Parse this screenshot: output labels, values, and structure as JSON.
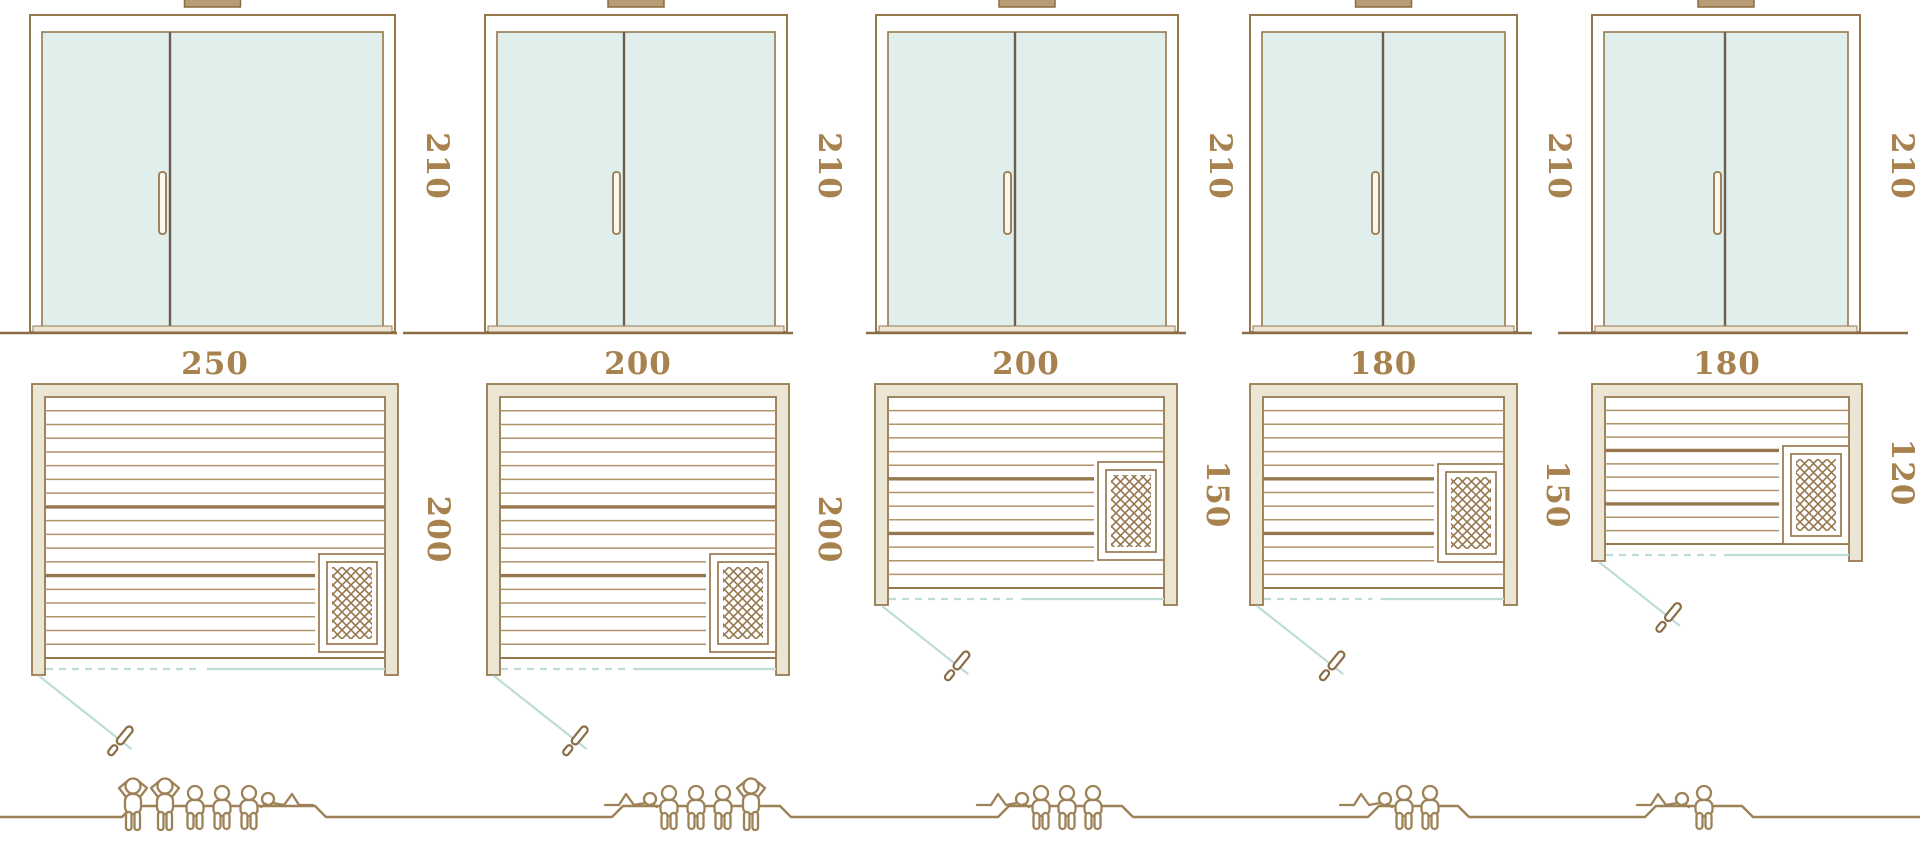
{
  "diagram_title": "sauna-size-comparison",
  "door_height_label": "210",
  "colors": {
    "line": "#96784f",
    "line_dark": "#8b6d45",
    "plank": "#b1936a",
    "plank_thick": "#97774e",
    "wall_fill": "#eae6d3",
    "glass": "#e1efec",
    "teal": "#bedcd8",
    "label": "#a8824e",
    "figure": "#9d8157",
    "divider": "#6b5e50",
    "vent_fill": "#b79c74",
    "white": "#ffffff"
  },
  "ground_y": 817,
  "platform_y": 806,
  "saunas": [
    {
      "name": "sauna-250x200",
      "width_label": "250",
      "depth_label": "200",
      "height_label": "210",
      "capacity": {
        "standing": 2,
        "sitting": 3,
        "lying": 1
      },
      "geometry": {
        "door": {
          "x": 30,
          "w": 365,
          "divider_x": 170
        },
        "plan": {
          "x": 32,
          "y": 384,
          "w": 366,
          "h": 291
        },
        "heater_y": 554,
        "swing_len": 118,
        "ground": [
          0,
          397
        ],
        "platform": [
          122,
          315
        ],
        "figures": [
          {
            "type": "standing",
            "x": 133
          },
          {
            "type": "standing",
            "x": 165
          },
          {
            "type": "sitting",
            "x": 195
          },
          {
            "type": "sitting",
            "x": 222
          },
          {
            "type": "sitting",
            "x": 249
          },
          {
            "type": "lying",
            "x": 268,
            "flip": false
          }
        ]
      }
    },
    {
      "name": "sauna-200x200",
      "width_label": "200",
      "depth_label": "200",
      "height_label": "210",
      "capacity": {
        "standing": 1,
        "sitting": 3,
        "lying": 1
      },
      "geometry": {
        "door": {
          "x": 485,
          "w": 302,
          "divider_x": 624
        },
        "plan": {
          "x": 487,
          "y": 384,
          "w": 302,
          "h": 291
        },
        "heater_y": 554,
        "swing_len": 118,
        "ground": [
          403,
          793
        ],
        "platform": [
          612,
          780
        ],
        "figures": [
          {
            "type": "lying",
            "x": 650,
            "flip": true
          },
          {
            "type": "sitting",
            "x": 669
          },
          {
            "type": "sitting",
            "x": 696
          },
          {
            "type": "sitting",
            "x": 723
          },
          {
            "type": "standing",
            "x": 751
          }
        ]
      }
    },
    {
      "name": "sauna-200x150",
      "width_label": "200",
      "depth_label": "150",
      "height_label": "210",
      "capacity": {
        "standing": 0,
        "sitting": 3,
        "lying": 1
      },
      "geometry": {
        "door": {
          "x": 876,
          "w": 302,
          "divider_x": 1015
        },
        "plan": {
          "x": 875,
          "y": 384,
          "w": 302,
          "h": 221
        },
        "heater_y": 462,
        "swing_len": 110,
        "ground": [
          866,
          1186
        ],
        "platform": [
          998,
          1122
        ],
        "figures": [
          {
            "type": "lying",
            "x": 1022,
            "flip": true
          },
          {
            "type": "sitting",
            "x": 1041
          },
          {
            "type": "sitting",
            "x": 1067
          },
          {
            "type": "sitting",
            "x": 1093
          }
        ]
      }
    },
    {
      "name": "sauna-180x150",
      "width_label": "180",
      "depth_label": "150",
      "height_label": "210",
      "capacity": {
        "standing": 0,
        "sitting": 2,
        "lying": 1
      },
      "geometry": {
        "door": {
          "x": 1250,
          "w": 267,
          "divider_x": 1383
        },
        "plan": {
          "x": 1250,
          "y": 384,
          "w": 267,
          "h": 221
        },
        "heater_y": 464,
        "swing_len": 110,
        "ground": [
          1242,
          1532
        ],
        "platform": [
          1368,
          1458
        ],
        "figures": [
          {
            "type": "lying",
            "x": 1385,
            "flip": true
          },
          {
            "type": "sitting",
            "x": 1404
          },
          {
            "type": "sitting",
            "x": 1430
          }
        ]
      }
    },
    {
      "name": "sauna-180x120",
      "width_label": "180",
      "depth_label": "120",
      "height_label": "210",
      "capacity": {
        "standing": 0,
        "sitting": 1,
        "lying": 1
      },
      "geometry": {
        "door": {
          "x": 1592,
          "w": 268,
          "divider_x": 1725
        },
        "plan": {
          "x": 1592,
          "y": 384,
          "w": 270,
          "h": 177
        },
        "heater_y": 446,
        "swing_len": 103,
        "ground": [
          1558,
          1908
        ],
        "platform": [
          1645,
          1742
        ],
        "figures": [
          {
            "type": "lying",
            "x": 1682,
            "flip": true
          },
          {
            "type": "sitting",
            "x": 1704
          }
        ]
      }
    }
  ]
}
